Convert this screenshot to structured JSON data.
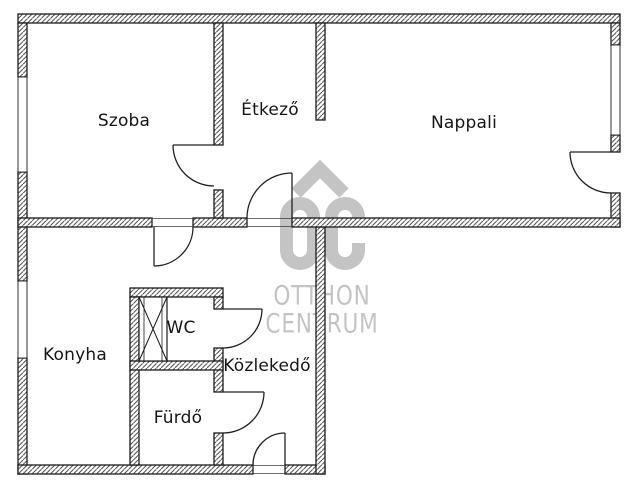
{
  "floorplan": {
    "rooms": [
      {
        "id": "szoba",
        "label": "Szoba"
      },
      {
        "id": "etkezo",
        "label": "Étkező"
      },
      {
        "id": "nappali",
        "label": "Nappali"
      },
      {
        "id": "konyha",
        "label": "Konyha"
      },
      {
        "id": "wc",
        "label": "WC"
      },
      {
        "id": "kozlekedo",
        "label": "Közlekedő"
      },
      {
        "id": "furdo",
        "label": "Fürdő"
      }
    ],
    "watermark": {
      "logo_text": "OC",
      "line1": "OTTHON",
      "line2": "CENTRUM",
      "color": "#c4c4c4"
    },
    "colors": {
      "wall_line": "#1c1c1c",
      "hatch": "#3f3f3f",
      "background": "#ffffff"
    }
  }
}
